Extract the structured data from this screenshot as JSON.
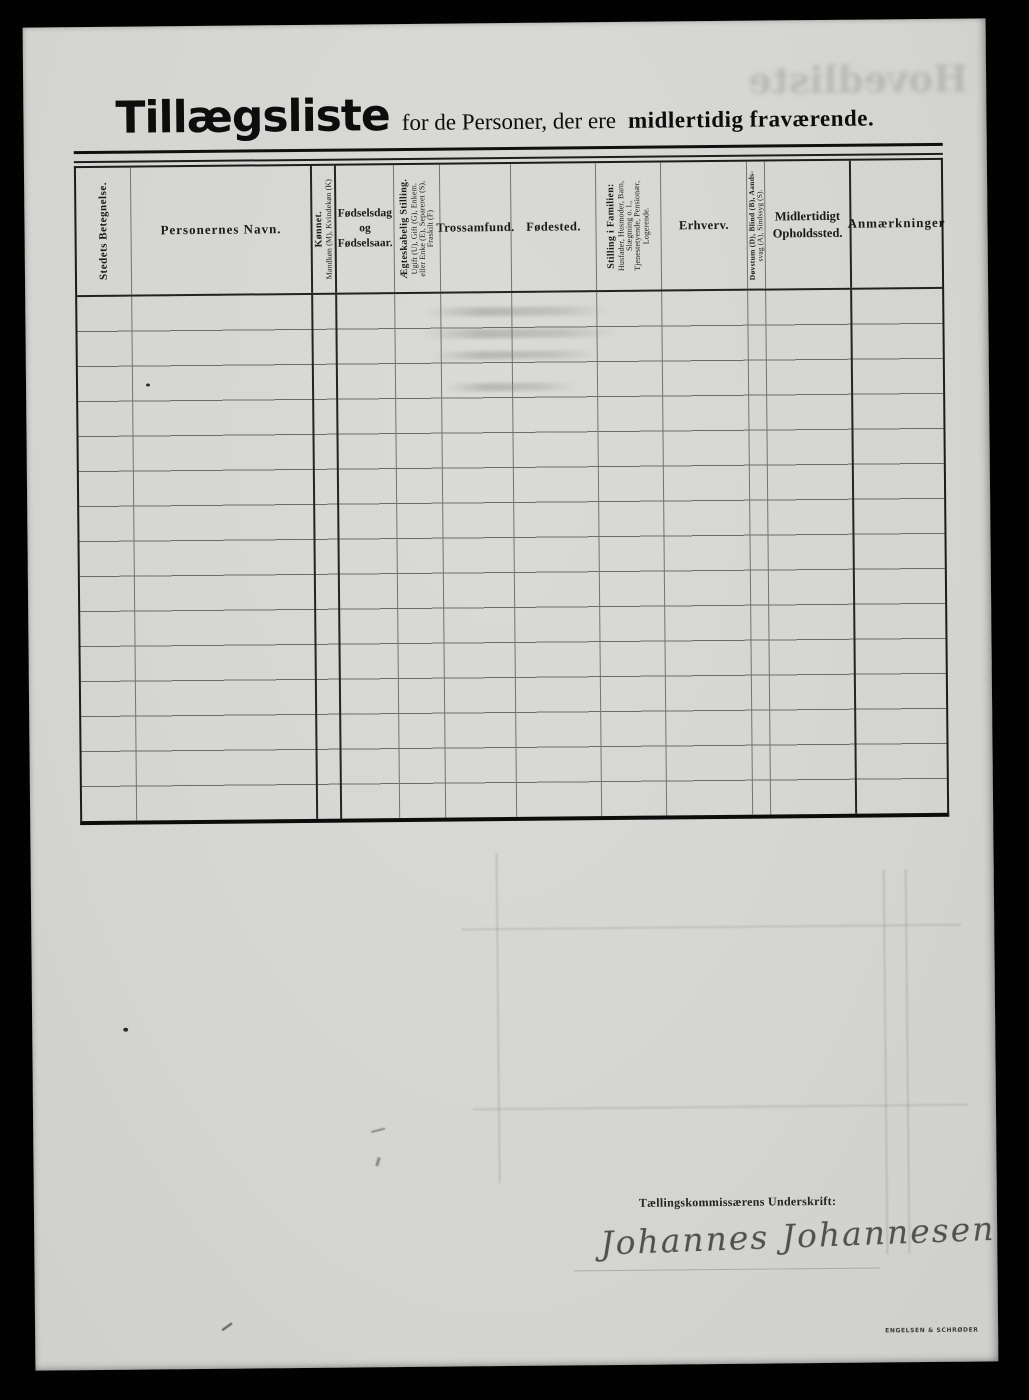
{
  "page": {
    "title": {
      "main": "Tillægsliste",
      "middle": "for de Personer, der ere",
      "emphasis": "midlertidig fraværende."
    },
    "bleedthrough_title": "Hovedliste",
    "table": {
      "row_count": 15,
      "columns": [
        {
          "orientation": "vertical",
          "lines": [
            "Stedets Betegnelse."
          ]
        },
        {
          "orientation": "horizontal",
          "lines": [
            "Personernes Navn."
          ]
        },
        {
          "orientation": "vertical",
          "lines": [
            "Kønnet.",
            "Mandkøn (M), Kvindekøn (K)"
          ]
        },
        {
          "orientation": "horizontal",
          "lines": [
            "Fødselsdag",
            "og",
            "Fødselsaar."
          ]
        },
        {
          "orientation": "vertical",
          "lines": [
            "Ægteskabelig Stilling.",
            "Ugift (U), Gift (G), Enkem.",
            "eller Enke (E), Separeret (S),",
            "Fraskilt (F)"
          ]
        },
        {
          "orientation": "horizontal",
          "lines": [
            "Trossamfund."
          ]
        },
        {
          "orientation": "horizontal",
          "lines": [
            "Fødested."
          ]
        },
        {
          "orientation": "vertical",
          "lines": [
            "Stilling i Familien:",
            "Husfader, Husmoder, Barn,",
            "Slægtning o. l.,",
            "Tjenestetyende, Pensionær,",
            "Logerende."
          ]
        },
        {
          "orientation": "horizontal",
          "lines": [
            "Erhverv."
          ]
        },
        {
          "orientation": "vertical",
          "lines": [
            "Døvstum (D), Blind (B), Aands-",
            "svag (A), Sindssyg (S)."
          ]
        },
        {
          "orientation": "horizontal",
          "lines": [
            "Midlertidigt",
            "Opholdssted."
          ]
        },
        {
          "orientation": "horizontal",
          "lines": [
            "Anmærkninger"
          ]
        }
      ]
    },
    "signature": {
      "label": "Tællingskommissærens Underskrift:",
      "name": "Johannes Johannesen"
    },
    "printer_mark": "ENGELSEN & SCHRØDER"
  },
  "colors": {
    "scan_background": "#020202",
    "paper": "#d5d5d2",
    "ink": "#161616",
    "line_heavy": "#1c1c1c",
    "line_light": "#74746d",
    "signature_ink": "#51514c"
  }
}
